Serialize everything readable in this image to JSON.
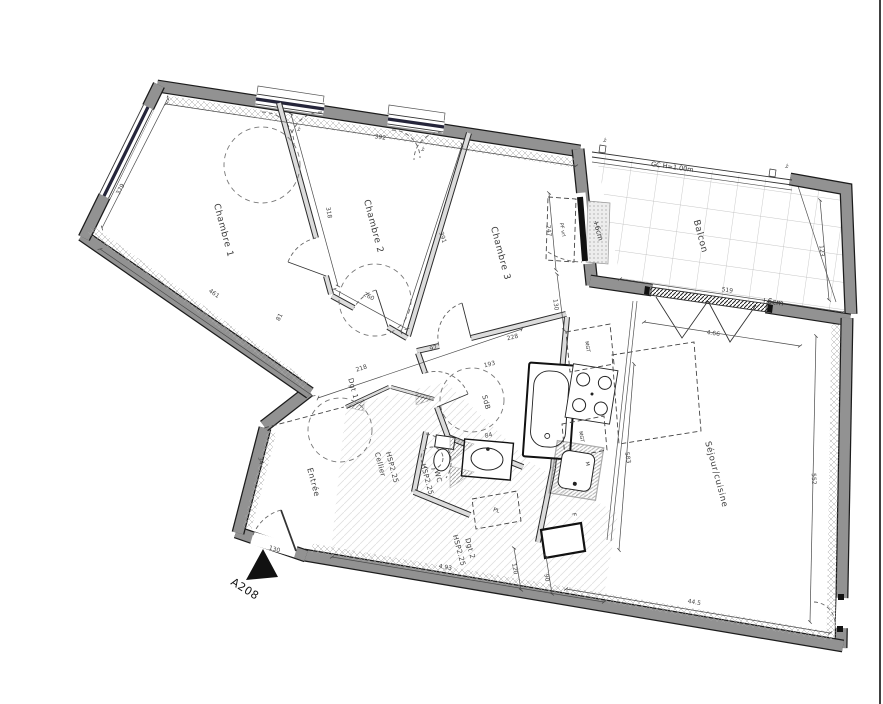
{
  "plan": {
    "unit": "A208",
    "rooms": {
      "c1": "Chambre 1",
      "c2": "Chambre 2",
      "c3": "Chambre 3",
      "balcony": "Balcon",
      "living": "Séjour/cuisine",
      "entry": "Entrée",
      "cellar": "Cellier",
      "wc": "WC",
      "bath": "SdB",
      "hall1": "Dgt 1",
      "hall2": "Dgt 2",
      "ceiling_height": "HSP2.25"
    },
    "annotations": {
      "guardrail": "GC H=1.00m",
      "level_offset": "+6cm",
      "balcony_door": "PF vrl",
      "window_mark": "vr"
    },
    "kitchen": {
      "unit_a": "MGT",
      "unit_b": "MGT",
      "unit_c": "M",
      "fridge": "F",
      "closet": "PL"
    },
    "dims": {
      "c1_left": "379",
      "c1_bottom": "461",
      "c1_wall": "318",
      "c2_top": "392",
      "c2_door": "260",
      "c2_wall": "391",
      "hall1_a": "218",
      "hall1_b": "92",
      "hall1_c": "81",
      "c3_door": "247",
      "c3_side": "130",
      "c3_bottom": "228",
      "bath_a": "193",
      "bath_b": "84",
      "living_top": "4.66",
      "living_left": "583",
      "living_right": "552",
      "living_bottom": "44.5",
      "hall2_bottom": "4.93",
      "hall2_a": "120",
      "hall2_b": "90",
      "balcony_width": "519",
      "balcony_side": "123",
      "entry_door": "130",
      "entry_side": "34"
    }
  }
}
